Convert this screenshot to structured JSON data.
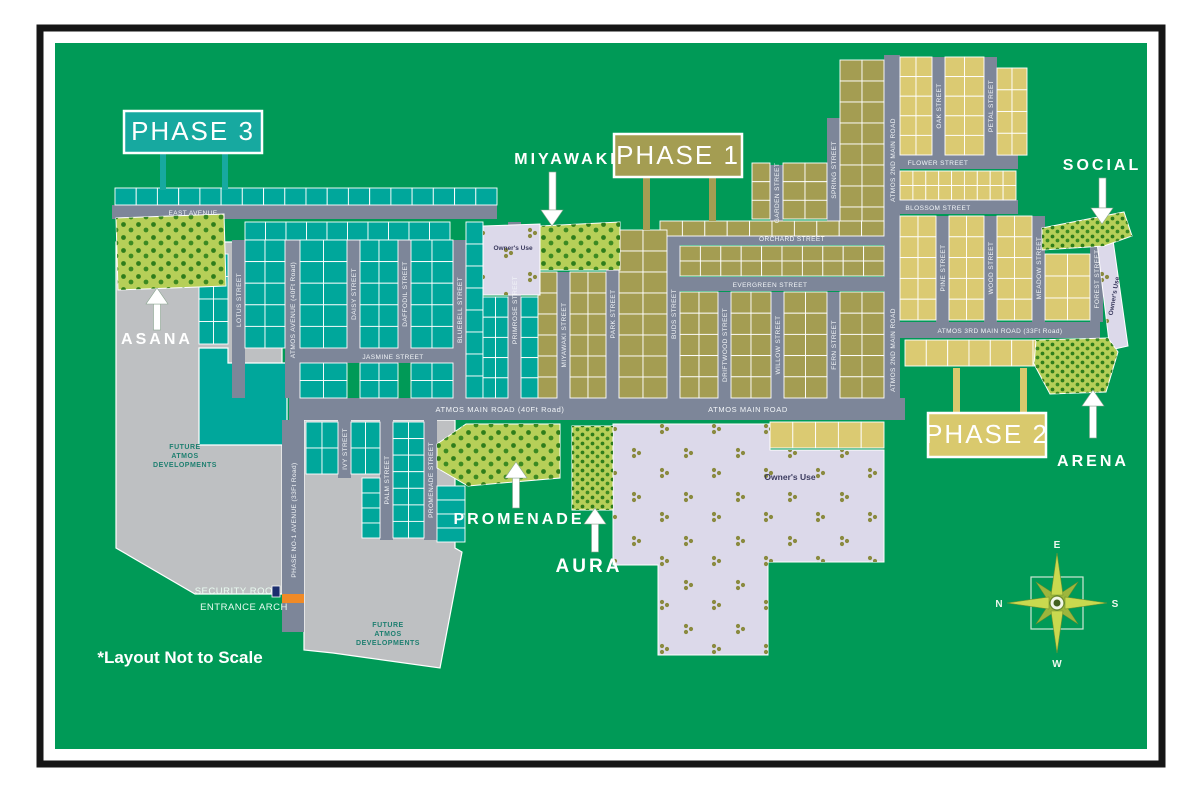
{
  "note": "*Layout Not to Scale",
  "phase_labels": {
    "phase1": "PHASE 1",
    "phase2": "PHASE 2",
    "phase3": "PHASE 3"
  },
  "amenity_labels": {
    "miyawaki": "MIYAWAKI",
    "social": "SOCIAL",
    "asana": "ASANA",
    "arena": "ARENA",
    "promenade": "PROMENADE",
    "aura": "AURA"
  },
  "streets": {
    "east_avenue": "EAST AVENUE",
    "lotus": "LOTUS STREET",
    "atmos_avenue": "ATMOS AVENUE (40Ft Road)",
    "daisy": "DAISY STREET",
    "daffodil": "DAFFODIL STREET",
    "bluebell": "BLUEBELL STREET",
    "jasmine": "JASMINE STREET",
    "primrose": "PRIMROSE STREET",
    "miyawaki_street": "MIYAWAKI STREET",
    "park": "PARK STREET",
    "buds": "BUDS STREET",
    "driftwood": "DRIFTWOOD STREET",
    "willow": "WILLOW STREET",
    "fern": "FERN STREET",
    "orchard": "ORCHARD STREET",
    "evergreen": "EVERGREEN STREET",
    "garden": "GARDEN STREET",
    "spring": "SPRING STREET",
    "atmos_2nd_main": "ATMOS 2ND MAIN ROAD",
    "flower": "FLOWER STREET",
    "oak": "OAK STREET",
    "petal": "PETAL STREET",
    "blossom": "BLOSSOM STREET",
    "pine": "PINE STREET",
    "wood": "WOOD STREET",
    "meadow": "MEADOW STREET",
    "forest": "FOREST STREET",
    "atmos_main_40": "ATMOS MAIN ROAD (40Ft Road)",
    "atmos_main": "ATMOS MAIN ROAD",
    "atmos_3rd_main": "ATMOS 3RD MAIN ROAD (33Ft Road)",
    "ivy": "IVY STREET",
    "palm": "PALM STREET",
    "promenade_street": "PROMENADE STREET",
    "phase_no1_avenue": "PHASE NO-1 AVENUE (33Ft Road)"
  },
  "areas": {
    "owners_use": "Owner's Use",
    "future_dev_lines": [
      "FUTURE",
      "ATMOS",
      "DEVELOPMENTS"
    ],
    "security_room": "SECURITY ROOM",
    "entrance_arch": "ENTRANCE ARCH"
  },
  "compass": {
    "north": "N",
    "east": "E",
    "south": "S",
    "west": "W"
  },
  "colors": {
    "background": "#009a57",
    "frame": "#161616",
    "road": "#7d8699",
    "phase3_plot": "#00a79b",
    "phase3_box": "#17a9a0",
    "phase1_plot": "#a49d52",
    "phase1_box": "#a49d52",
    "phase2_plot": "#dbca72",
    "phase2_box": "#d9c96d",
    "future_area": "#bec0c2",
    "owners_area": "#dcd9ea",
    "amenity_green": "#b6cf58",
    "tree": "#2f7d1b",
    "entrance_arch": "#f08a26",
    "security_room": "#1b2e6e",
    "north_letter": "#e0523a"
  }
}
